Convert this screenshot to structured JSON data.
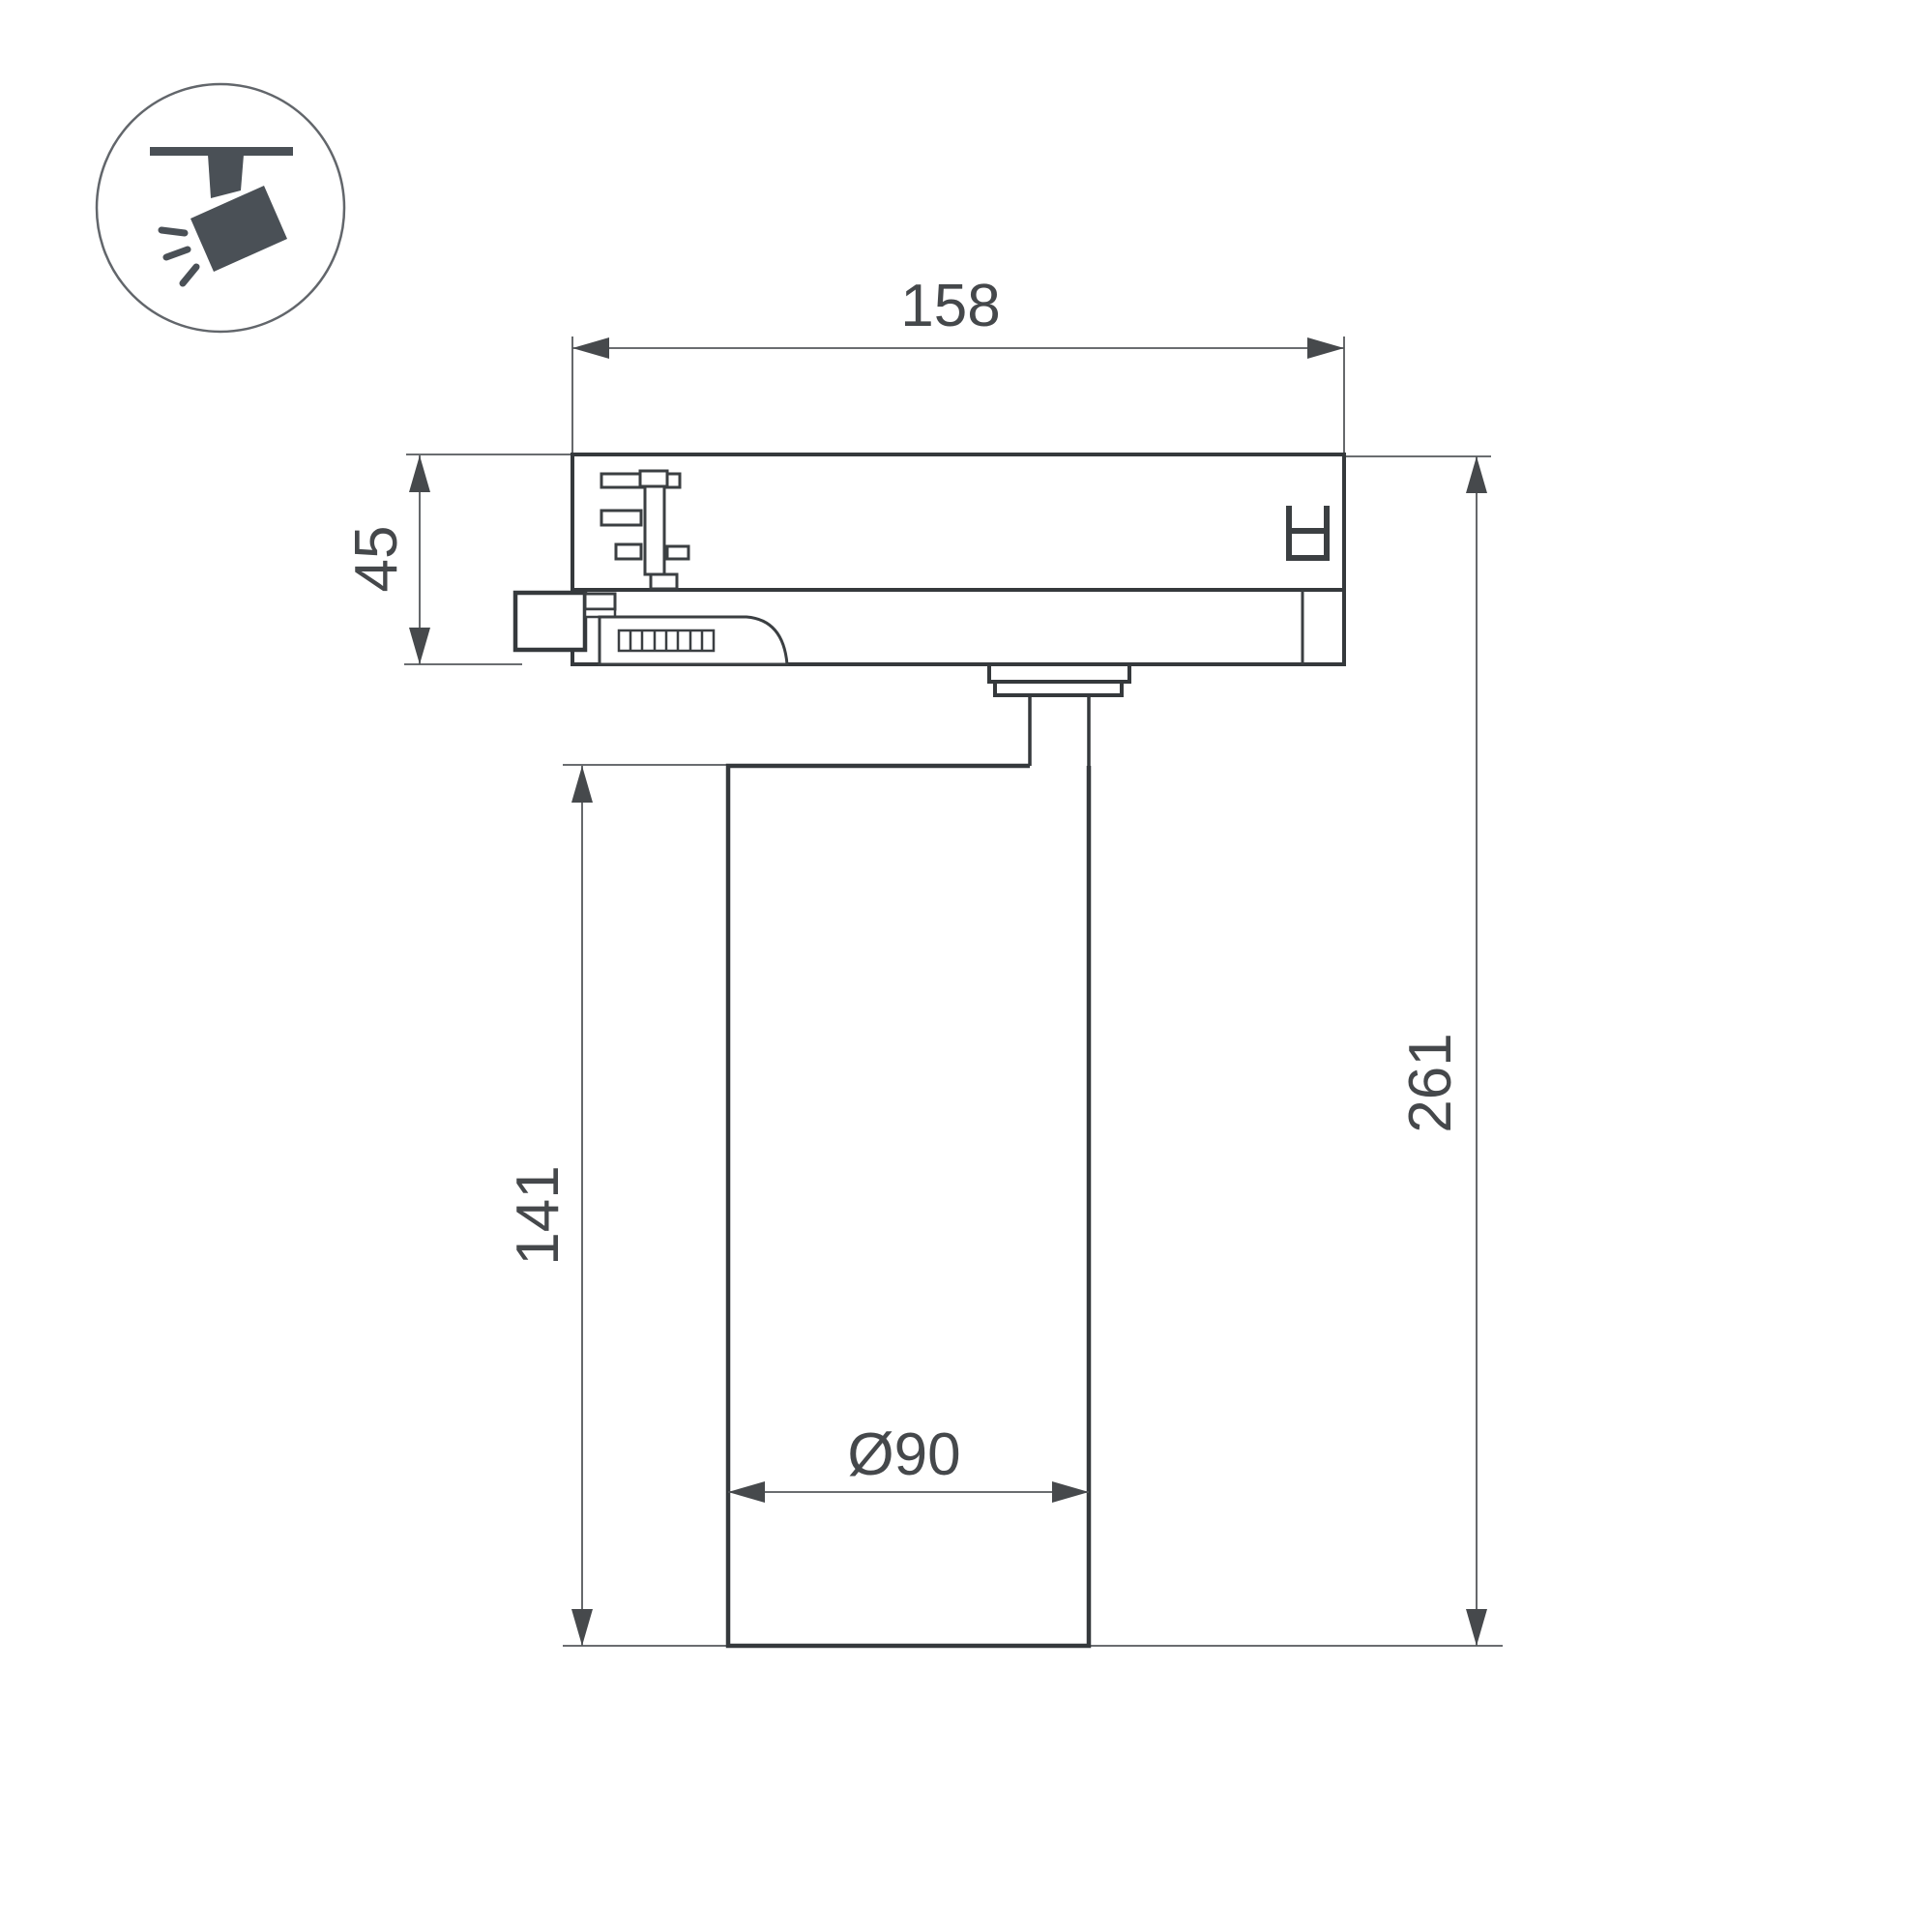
{
  "drawing": {
    "kind": "technical-dimension-drawing",
    "subject": "track-mounted cylindrical spotlight, side view"
  },
  "icon": {
    "name": "track-spotlight-icon",
    "color": "#4a5056",
    "circle_stroke": "#62666b"
  },
  "colors": {
    "background": "#ffffff",
    "outline": "#35393c",
    "detail": "#3b3f42",
    "dimension_line": "#55585b",
    "arrow": "#46494c",
    "text": "#45484b"
  },
  "dimensions": {
    "track_adapter_width": "158",
    "adapter_height": "45",
    "body_height": "141",
    "total_height": "261",
    "body_diameter": "Ø90"
  }
}
